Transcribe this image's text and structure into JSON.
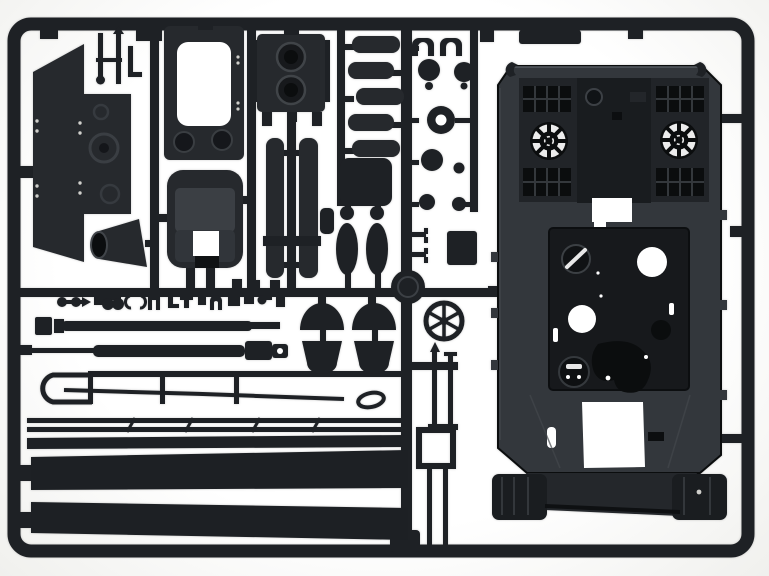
{
  "scene": {
    "type": "photograph",
    "subject": "injection-molded plastic model kit sprue (dark grey) with tank upper hull and detail parts on a white background",
    "text_visible": "none"
  },
  "colors": {
    "bg-center": "#ffffff",
    "bg-edge": "#f0f0ed",
    "plastic": "#1e2125",
    "plastic-mid": "#26292d",
    "hull": "#33373c",
    "hull-recess": "#17191c",
    "hull-dark": "#0b0d0e",
    "hull-light": "#4c5156",
    "white-cut": "#ffffff"
  },
  "parts": {
    "photo": "model kit sprue photograph",
    "frame": "rectangular sprue frame with gates and tabs",
    "runners": "internal sprue runners",
    "hull": "tank upper hull with twin cooling fan intakes, engine grilles, hatches and rectangular cutouts",
    "side_plate": "angled superstructure side plate with rivets",
    "hatch_panel": "hatch frame panel with rounded opening",
    "tub": "rounded hatch tub with square cutout",
    "filter_box": "twin round-recess filter box",
    "recoil_cylinders": "pair of vertical gun recoil cylinders",
    "mufflers": "stack of five horizontal muffler cylinders",
    "bottles": "two bottle-shaped fittings",
    "small_parts_column": "column of wheels, ring, clamps and blocks",
    "idler_wheel": "large solid idler wheel",
    "spoked_wheel": "open six-spoke wheel",
    "mudguard_ends": "four curved mudguard end caps",
    "gun_barrels": "two long barrel rods with muzzle fittings",
    "tow_cable": "long tow cable with loop ends",
    "rails": "thin twin side rails with cross ties",
    "fender_strips": "two long dark fender strips",
    "jack": "vertical jack rods and frame",
    "tiny_fittings": "row of small clips and fittings on lower runner"
  }
}
